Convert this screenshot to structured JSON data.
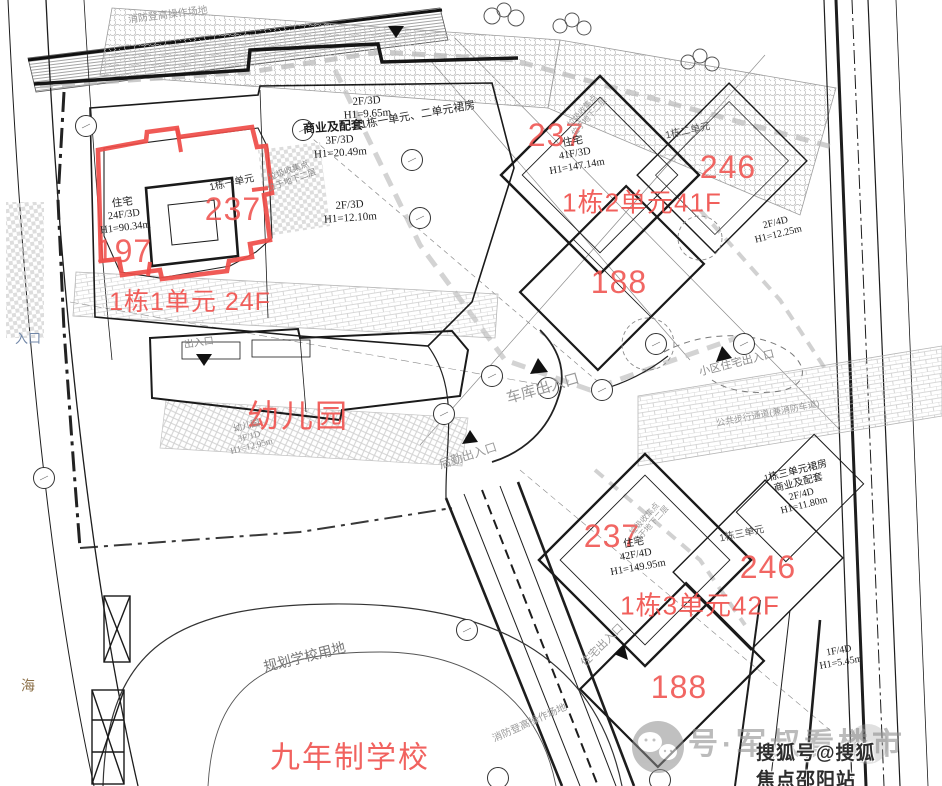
{
  "colors": {
    "red": "#f0524e",
    "gray_text": "#9a9a9a",
    "dark_line": "#1d1d1d",
    "blue_text": "#7187a8",
    "watermark_gray": "#8e8e8e"
  },
  "site": {
    "fire_lane_top": "消防登高操作场地",
    "fire_lane_bottom": "消防登高操作场地",
    "walkway": "公共步行通道(兼消防车道)",
    "road_entry": "入口",
    "road_sea": "海"
  },
  "entrances": {
    "main": "出入口",
    "garage": "车库出入口",
    "service": "后勤出入口",
    "community": "小区住宅出入口",
    "resident": "住宅出入口"
  },
  "buildings": {
    "unit1": {
      "area_right": "237",
      "area_left": "197",
      "use": "住宅",
      "floors": "24F/3D",
      "height": "H1=90.34m",
      "tag": "1栋一单元",
      "caption": "1栋1单元 24F"
    },
    "podium12": {
      "upper_floors": "2F/3D",
      "upper_height": "H1=9.65m",
      "use": "商业及配套",
      "floors": "3F/3D",
      "height": "H1=20.49m",
      "tag": "1栋一单元、二单元裙房",
      "lower_floors": "2F/3D",
      "lower_height": "H1=12.10m",
      "trash_line1": "垃圾收集点",
      "trash_line2": "位于地下二层"
    },
    "unit2": {
      "area_left": "237",
      "use": "住宅",
      "floors": "41F/3D",
      "height": "H1=147.14m",
      "tag": "1栋二单元",
      "area_right": "246",
      "caption": "1栋2单元41F",
      "area_lower": "188",
      "annex_floors": "2F/4D",
      "annex_height": "H1=12.25m",
      "trash_line1": "垃圾收集点",
      "trash_line2": "位于地下二层"
    },
    "unit3": {
      "area_left": "237",
      "use": "住宅",
      "floors": "42F/4D",
      "height": "H1=149.95m",
      "tag": "1栋三单元",
      "area_right": "246",
      "caption": "1栋3单元42F",
      "area_lower": "188",
      "annex_floors": "1F/4D",
      "annex_height": "H1=5.45m",
      "podium_tag": "1栋三单元裙房",
      "podium_use": "商业及配套",
      "podium_floors": "2F/4D",
      "podium_height": "H1=11.80m",
      "trash_line1": "垃圾收集点",
      "trash_line2": "位于地下二层"
    },
    "kindergarten": {
      "name": "幼儿园",
      "small_name": "幼儿园",
      "floors": "3F/1D",
      "height": "H1=12.95m"
    },
    "school": {
      "site_label": "规划学校用地",
      "name": "九年制学校"
    }
  },
  "watermark": {
    "wechat_text": "号·军叔看楼市",
    "sohu_text": "搜狐号@搜狐焦点邵阳站"
  }
}
